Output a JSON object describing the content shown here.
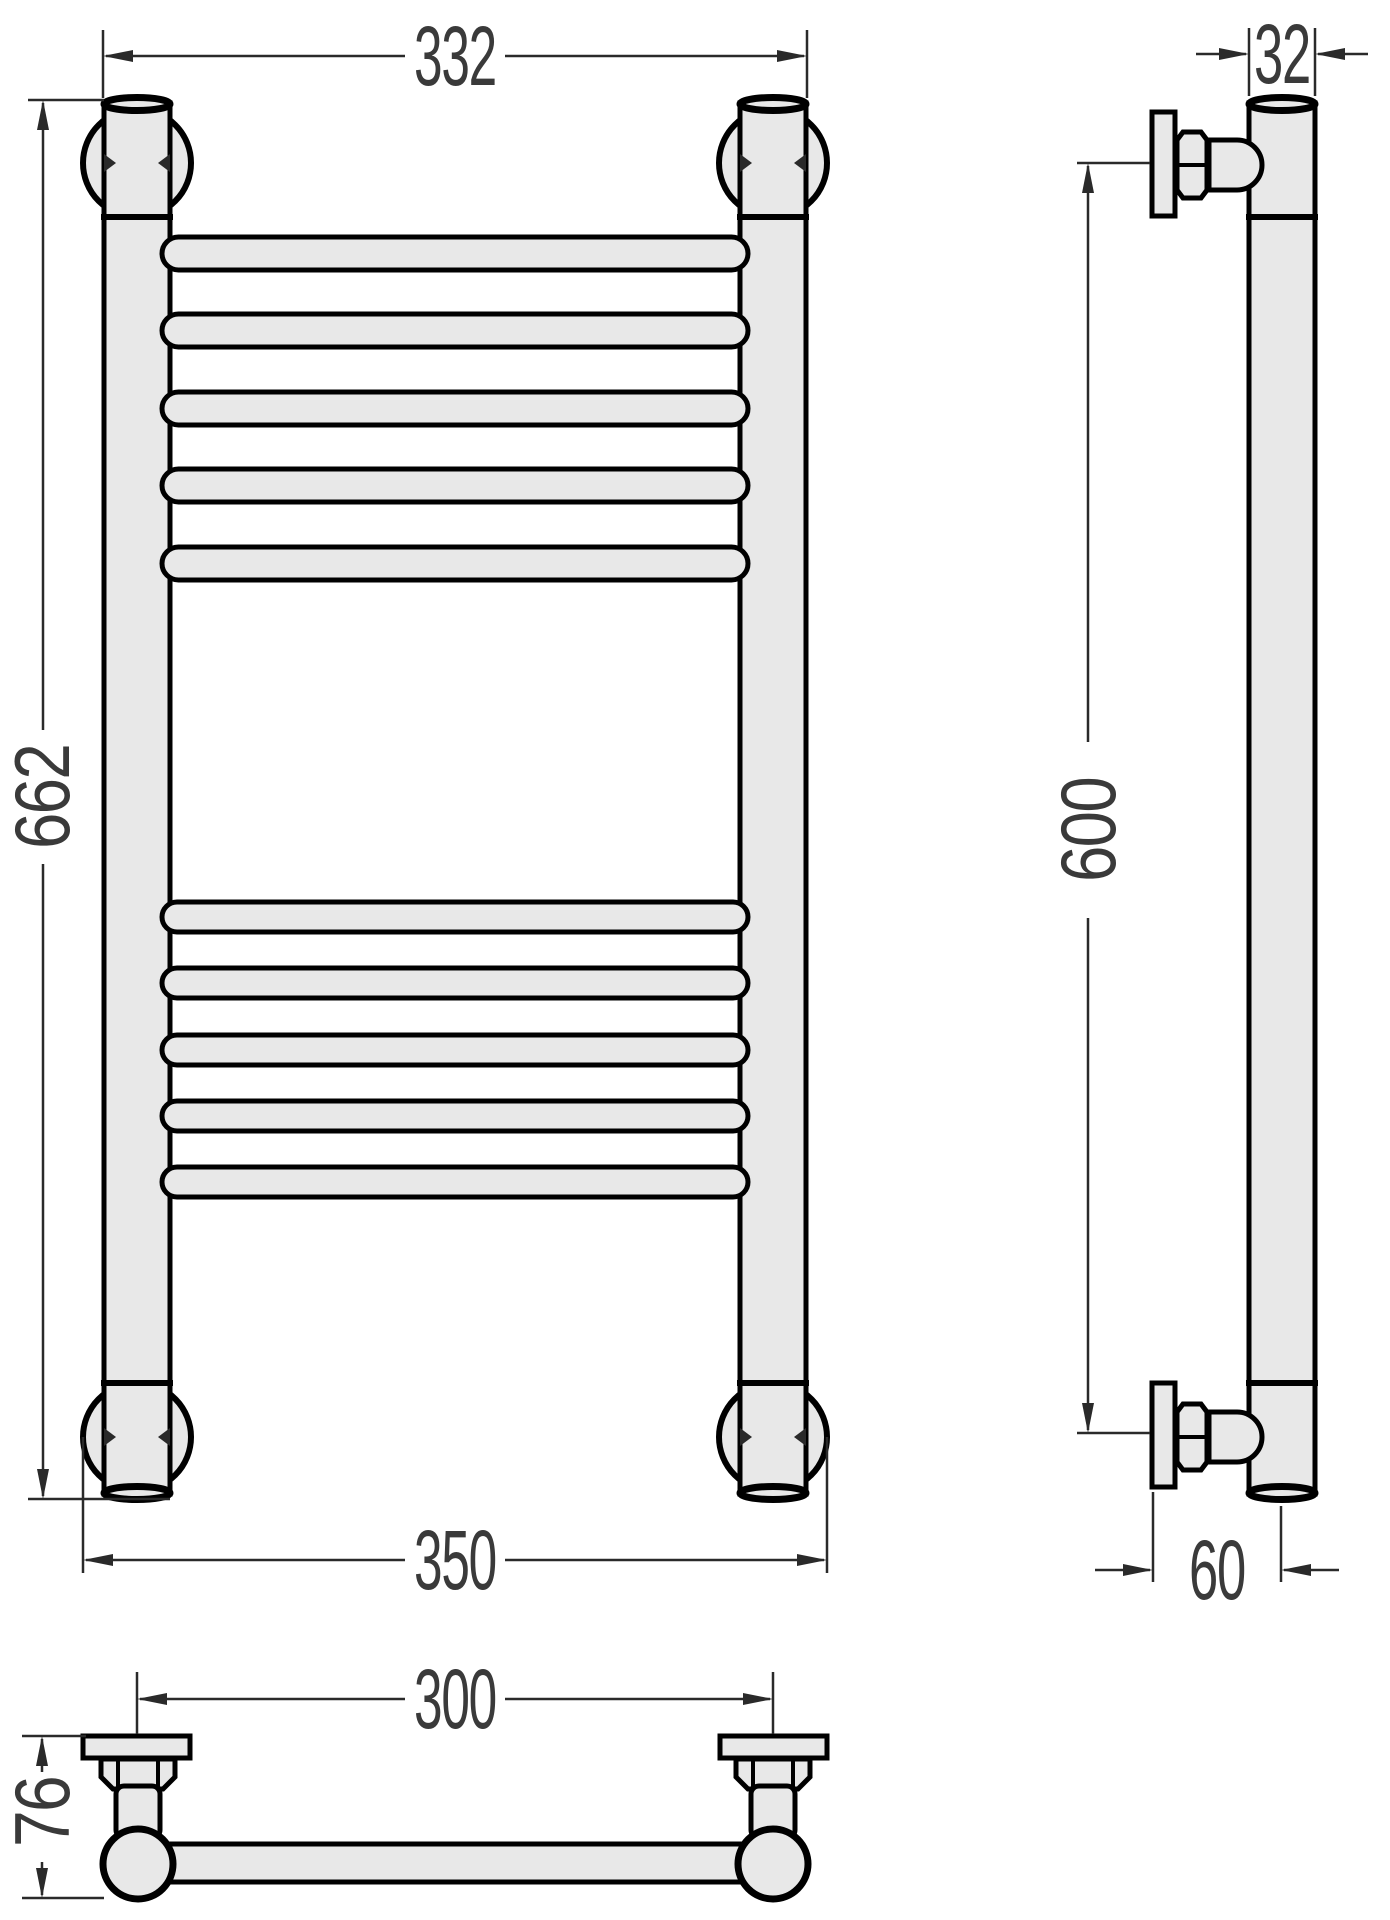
{
  "drawing": {
    "subject": "heated-towel-rail-technical-drawing",
    "colors": {
      "background": "#ffffff",
      "part_fill": "#e8e8e8",
      "part_outline": "#000000",
      "dimension_lines": "#2a2a2a",
      "dimension_text": "#3a3a3a"
    },
    "dims": {
      "front_width_top": "332",
      "front_height": "662",
      "front_width_bottom": "350",
      "side_tube_diameter": "32",
      "side_mount_height": "600",
      "side_wall_offset": "60",
      "top_mount_spacing": "300",
      "top_depth": "76"
    }
  }
}
